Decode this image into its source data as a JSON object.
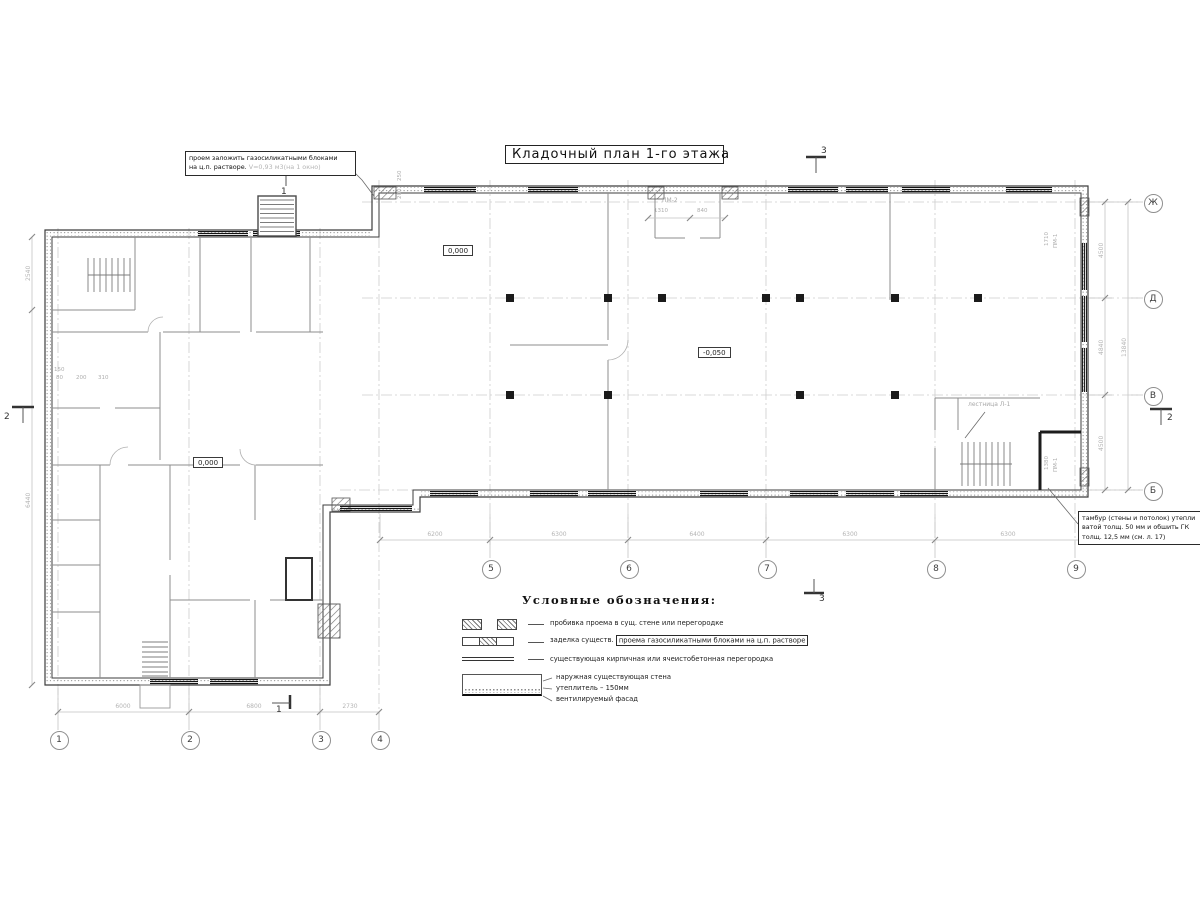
{
  "title": "Кладочный план 1-го этажа",
  "annotations": {
    "opening_note": {
      "line1": "проем заложить газосиликатными блоками",
      "line2": "на ц.п. растворе.",
      "detail": "V=0,93 м3(на 1 окно)"
    },
    "tambour_note": {
      "line1": "тамбур (стены и потолок) утепли",
      "line2": "ватой толщ. 50 мм и обшить ГК",
      "line3": "толщ. 12,5 мм (см. л. 17)"
    },
    "stair_label": "лестница Л-1"
  },
  "elevations": {
    "wing": "0,000",
    "left_block": "0,000",
    "hall": "-0,050"
  },
  "axes": {
    "bottom": [
      "1",
      "2",
      "3",
      "4"
    ],
    "wing": [
      "5",
      "6",
      "7",
      "8",
      "9"
    ],
    "right": [
      "Ж",
      "Д",
      "В",
      "Б"
    ]
  },
  "sections": {
    "s1": "1",
    "s2": "2",
    "s3": "3"
  },
  "dimensions": {
    "bottom": [
      "6000",
      "6800",
      "2730"
    ],
    "wing": [
      "6200",
      "6300",
      "6400",
      "6300",
      "6300"
    ],
    "right_inner": [
      "4500",
      "4840",
      "4500"
    ],
    "right_total": "13840",
    "left_upper": "2540",
    "left_lower": "6440",
    "top_small": [
      "250",
      "200"
    ],
    "wall_small": [
      "150",
      "80",
      "200",
      "310"
    ],
    "pm2": {
      "label": "ПМ-2",
      "d1": "1310",
      "d2": "840"
    },
    "pm1_top": {
      "label": "ПМ-1",
      "d": "1710"
    },
    "pm1_bottom": {
      "label": "ПМ-1",
      "d": "1380"
    }
  },
  "legend": {
    "header": "Условные обозначения:",
    "item1": "пробивка проема  в сущ. стене  или перегородке",
    "item2_prefix": "заделка существ.",
    "item2_boxed": "проема газосиликатными блоками на ц.п. растворе",
    "item3": "существующая кирпичная или ячеистобетонная перегородка",
    "wall_callout1": "наружная существующая стена",
    "wall_callout2": "утеплитель – 150мм",
    "wall_callout3": "вентилируемый фасад"
  }
}
